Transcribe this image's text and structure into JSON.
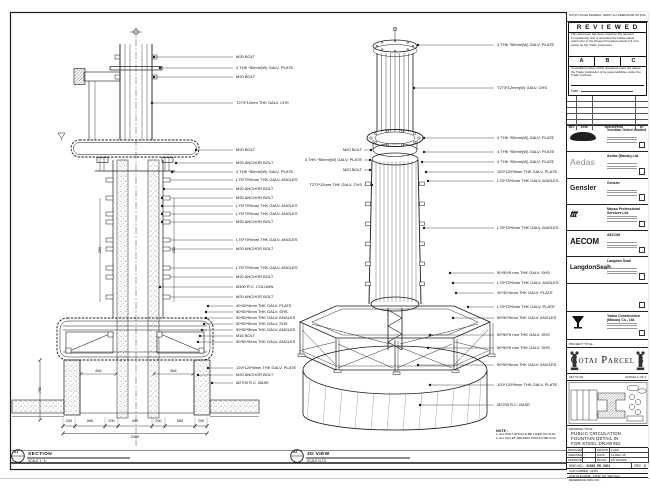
{
  "sheet": {
    "edge_note": "DO NOT SCALE DRAWING. VERIFY ALL DIMENSIONS ON SITE.",
    "project_strip_label": "PROJECT TITLE",
    "key_plan_label": "KEY PLAN",
    "key_plan_right": "PARCEL 1 OF 3"
  },
  "stamp": {
    "title": "R E V I E W E D",
    "para1": "This document has been noted by the relevant Consultant(s) and is accorded the follow status referred to in the Project Procedure Section 5.4 for action by the Trade Contractor.",
    "grades": [
      "A",
      "B",
      "C"
    ],
    "para2": "Consultant review of this document does not relieve the Trade Contractor of its responsibilities under the Trade Contract.",
    "date_label": "Date :"
  },
  "revision_table": {
    "headers": [
      "REV",
      "DATE",
      "DESCRIPTION",
      "BY"
    ]
  },
  "consultants": [
    {
      "logo": "",
      "logo_style": "venetian",
      "name": "Venetian Orient Limited"
    },
    {
      "logo": "Aedas",
      "logo_style": "aedas",
      "name": "Aedas (Macau) Ltd."
    },
    {
      "logo": "Gensler",
      "logo_style": "gensler",
      "name": "Gensler"
    },
    {
      "logo": "ttt",
      "logo_style": "mps",
      "name": "Macau Professional Services Ltd."
    },
    {
      "logo": "AECOM",
      "logo_style": "aecom",
      "name": "AECOM"
    },
    {
      "logo": "LangdonSeah",
      "logo_style": "langdon",
      "name": "Langdon Seah"
    }
  ],
  "contractor": {
    "name": "Yadea Construction (Macau) Co., Ltd."
  },
  "project": {
    "name": "Cotai Parcel 3"
  },
  "title_block": {
    "drawing_title_label": "DRAWING TITLE :",
    "title_lines": [
      "PUBLIC CIRCULATION",
      "FOUNTAIN DETAIL IN",
      "FOR STEEL DRAWING"
    ],
    "fields": [
      {
        "label": "DESIGNED",
        "value": ""
      },
      {
        "label": "DRAWN",
        "value": "LUNG"
      },
      {
        "label": "CHECKED",
        "value": "-"
      },
      {
        "label": "DATE",
        "value": "14-DEC-15"
      },
      {
        "label": "APPROVED",
        "value": "-"
      },
      {
        "label": "SCALE",
        "value": "AS SHOWN"
      }
    ],
    "dwg_label": "DWG NO :",
    "dwg_no": "31545_PD_0001",
    "rev_label": "REV :",
    "rev": "C",
    "cadnum_label": "CAD NUMBER :",
    "cadnum": "31545",
    "cadfile_label": "CAD FILE NAME :",
    "cadfile": "31545_PD_0001.dwg",
    "ref_label": "REFERENCE DWG NO :"
  },
  "views": {
    "section": {
      "num": "01",
      "sheet_ref": "-",
      "name": "SECTION",
      "scale": "SCALE 1 : 5"
    },
    "iso": {
      "num": "02",
      "sheet_ref": "-",
      "name": "3D VIEW",
      "scale": "SCALE N.T.S."
    }
  },
  "notes": {
    "heading": "NOTE :",
    "items": [
      "1. ALL BOLT SHOULD BE FIXED ON SITE.",
      "2. ALL FILLET WELDED SHOULD BE 6mm."
    ]
  },
  "callouts": {
    "section_right": [
      "M20 BOLT",
      "4 THK *50mm(W) GALV. PLATE",
      "M20 BOLT",
      "T273*12mm THK GALV. CHS",
      "M20 BOLT",
      "M20 ANCHOR BOLT",
      "4 THK *50mm(W) GALV. PLATE",
      "L75*75*6mm THK GALV. ANGLES",
      "M20 ANCHOR BOLT",
      "M20 ANCHOR BOLT",
      "L75*75*6mm THK GALV. ANGLES",
      "L75*75*6mm THK GALV. ANGLES",
      "M20 ANCHOR BOLT",
      "L75*75*6mm THK GALV. ANGLES",
      "M20 ANCHOR BOLT",
      "L75*75*6mm THK GALV. ANGLES",
      "M20 ANCHOR BOLT",
      "Ø300 R.C. COLUMN",
      "M20 ANCHOR BOLT",
      "40*40*4mm THK GALV. PLATE",
      "50*50*5mm THK GALV. SHS",
      "50*50*5mm THK GALV. ANGLES",
      "50*50*5mm THK GALV. SHS",
      "50*50*5mm THK GALV. ANGLES",
      "M16 BOLT",
      "50*50*5mm THK GALV. ANGLES",
      "120*120*8mm THK GALV. PLATE",
      "M20 ANCHOR BOLT",
      "Ø2700 R.C. BASE"
    ],
    "iso_right": [
      "4 THK *50mm(W) GALV. PLATE",
      "T273*12mm(W) GALV. CHS",
      "4 THK *50mm(W) GALV. PLATE",
      "4 THK *50mm(W) GALV. PLATE",
      "4 THK *50mm(W) GALV. PLATE",
      "120*120*8mm THK GALV. PLATE",
      "L75*75*6mm THK GALV. ANGLES",
      "L75*75*6mm THK GALV. ANGLES",
      "50*50*5 mm THK GALV. SHS",
      "L75*75*6mm THK GALV. ANGLES",
      "40*40*4mm THK GALV. PLATE",
      "L75*75*6mm THK GALV. PLATE",
      "50*50*5mm THK GALV. ANGLES",
      "50*50*5 mm THK GALV. SHS",
      "50*50*5 mm THK GALV. SHS",
      "50*50*5mm THK GALV. ANGLES",
      "120*120*8mm THK GALV. PLATE",
      "Ø2700 R.C. BASE"
    ],
    "iso_left": [
      "M20 BOLT",
      "4 THK *50mm(W) GALV. PLATE",
      "M20 BOLT",
      "T273*12mm THK GALV. CHS"
    ]
  },
  "dimensions": {
    "bottom_segments": [
      "200",
      "565",
      "200",
      "450",
      "200",
      "565",
      "200"
    ],
    "bottom_total": "2380",
    "mid_left": "864",
    "mid_right": "864",
    "vertical": "750",
    "column_left": "250",
    "column_right": "250"
  }
}
